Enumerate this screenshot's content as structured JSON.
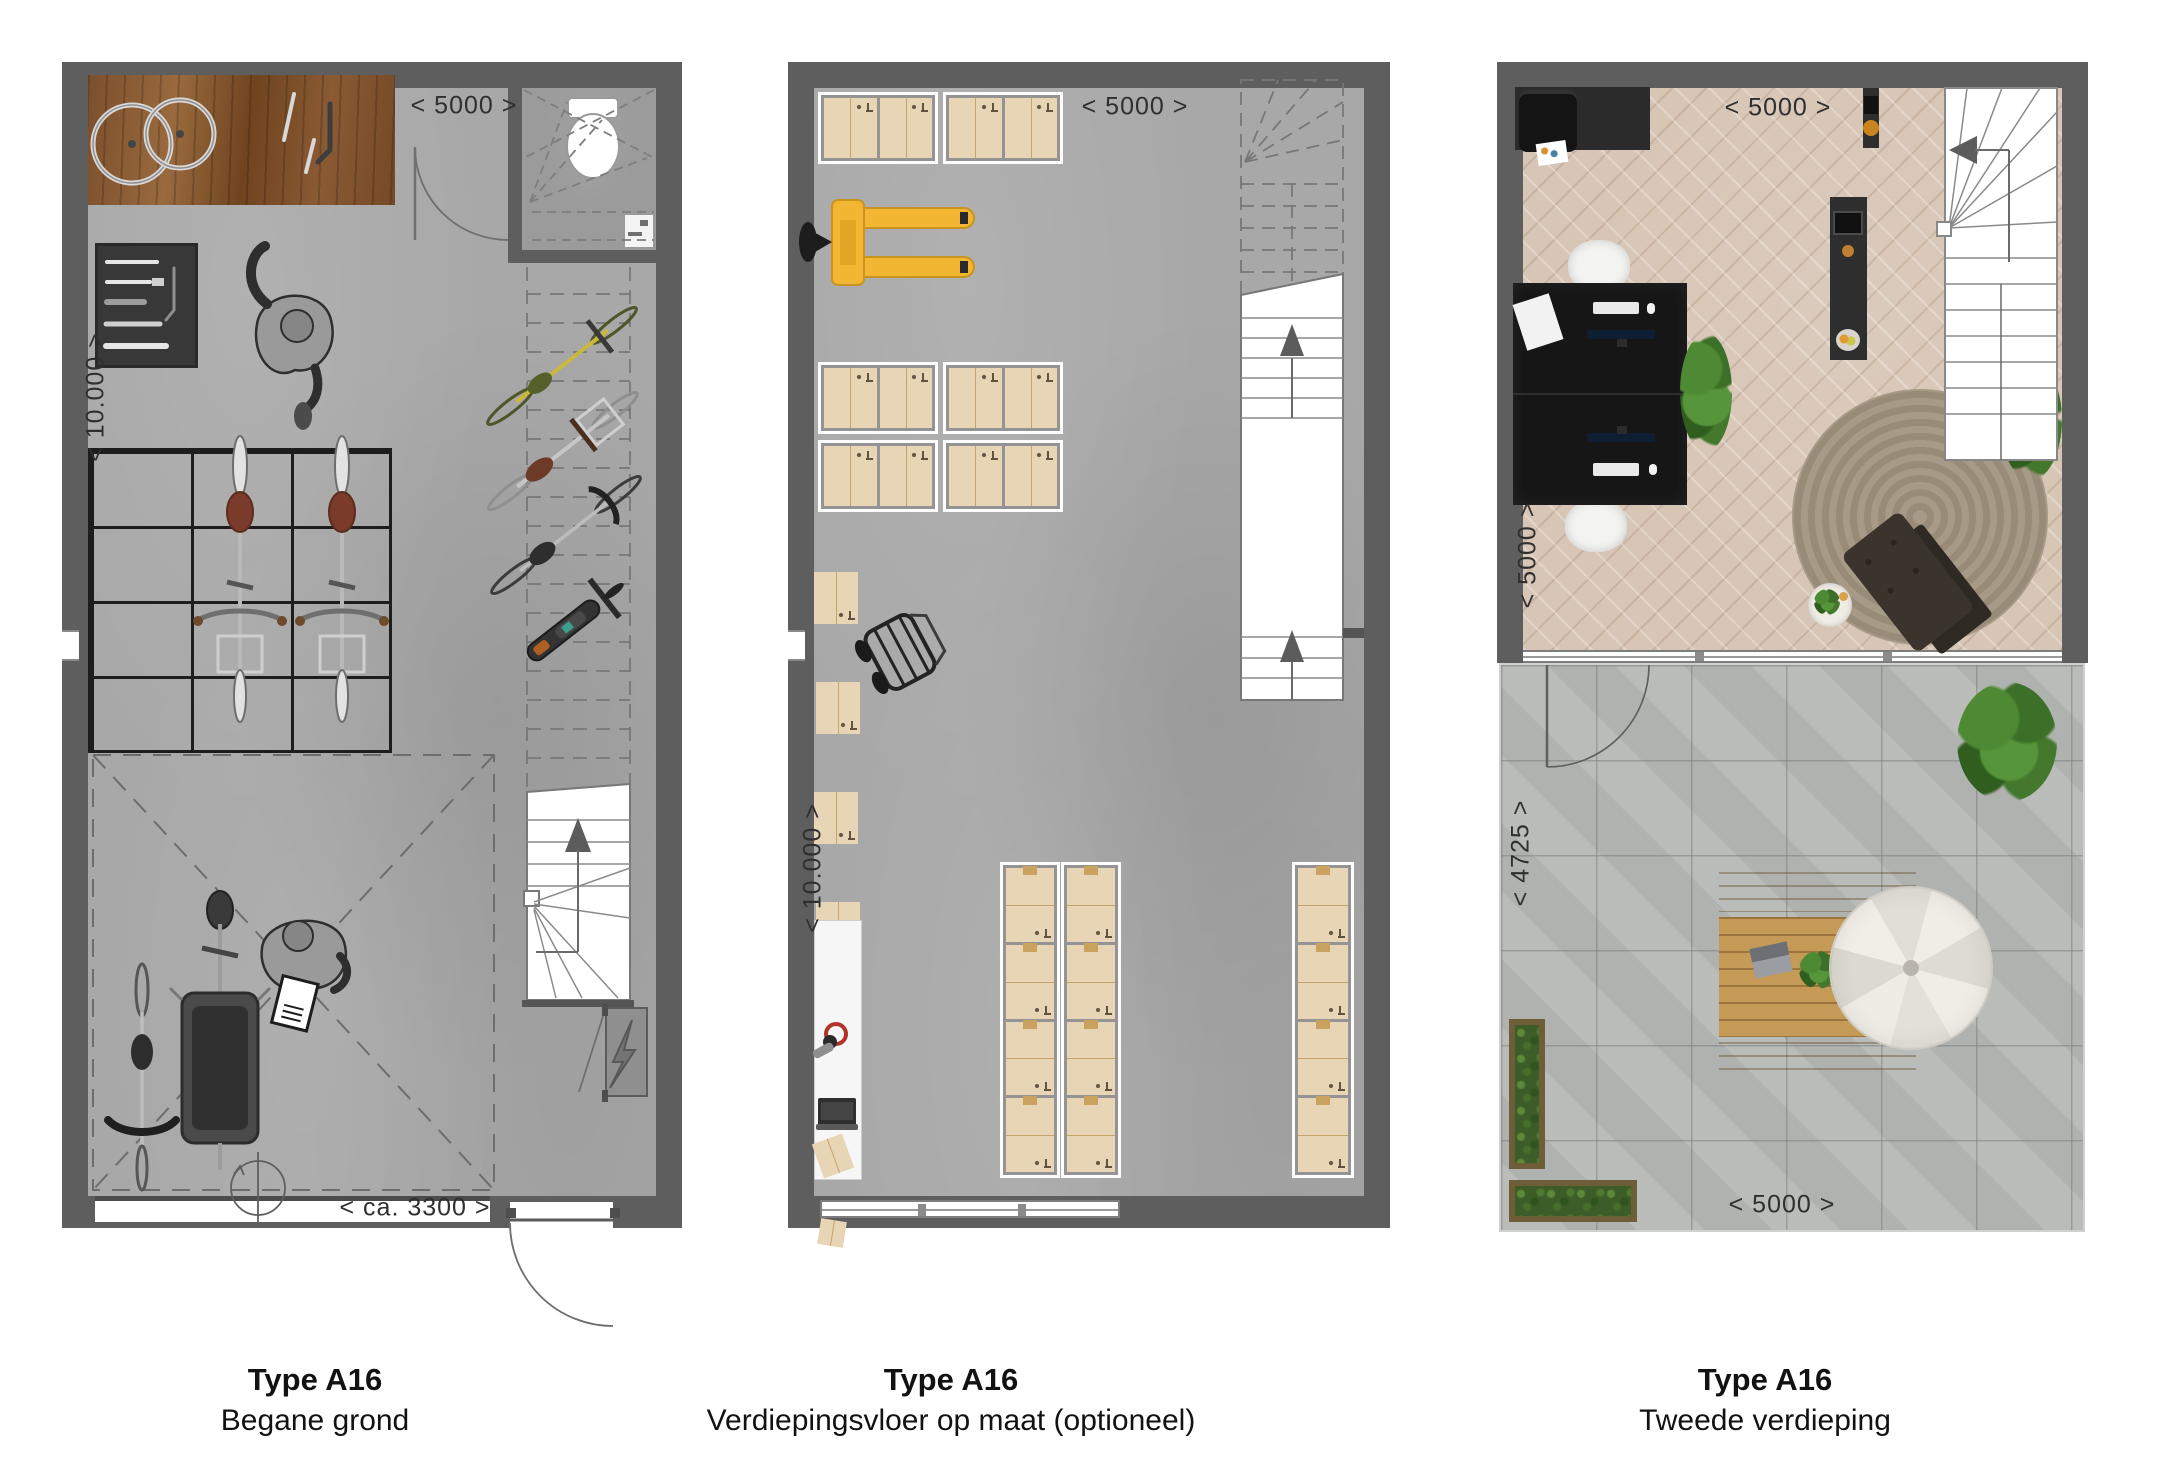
{
  "sheet": {
    "background": "#ffffff"
  },
  "colors": {
    "wall": "#5e5e5e",
    "concrete_floor": "#a8a8a8",
    "stair_white": "#ffffff",
    "box_cardboard": "#e8d5b5",
    "pallet_jack_yellow": "#f2b632",
    "workbench_wood": "#855632",
    "parquet_wood": "#d7c5b5",
    "terrace_tile": "#b6b9b5",
    "rug": "#a0937f",
    "sofa_brown": "#3b342c",
    "plant_green": "#4c8032",
    "label_text": "#2f2f2f"
  },
  "icons": {
    "stairs-up-arrow": "▲",
    "stairs-down-arrow": "◀",
    "lightning-bolt": "⚡",
    "door-swing-arc": "quarter-circle",
    "rotation-arrow": "circle-arrow"
  },
  "plans": [
    {
      "id": "begane-grond",
      "caption": {
        "title": "Type A16",
        "subtitle": "Begane grond"
      },
      "dims": {
        "top": "< 5000 >",
        "left": "< 10.000 >",
        "bottom": "< ca. 3300 >"
      }
    },
    {
      "id": "verdiepingsvloer-op-maat",
      "caption": {
        "title": "Type A16",
        "subtitle": "Verdiepingsvloer op maat (optioneel)"
      },
      "dims": {
        "top": "< 5000 >",
        "left": "< 10.000 >"
      }
    },
    {
      "id": "tweede-verdieping",
      "caption": {
        "title": "Type A16",
        "subtitle": "Tweede verdieping"
      },
      "dims": {
        "top": "< 5000 >",
        "left_upper": "< 5000 >",
        "left_lower": "< 4725 >",
        "bottom": "< 5000 >"
      }
    }
  ]
}
